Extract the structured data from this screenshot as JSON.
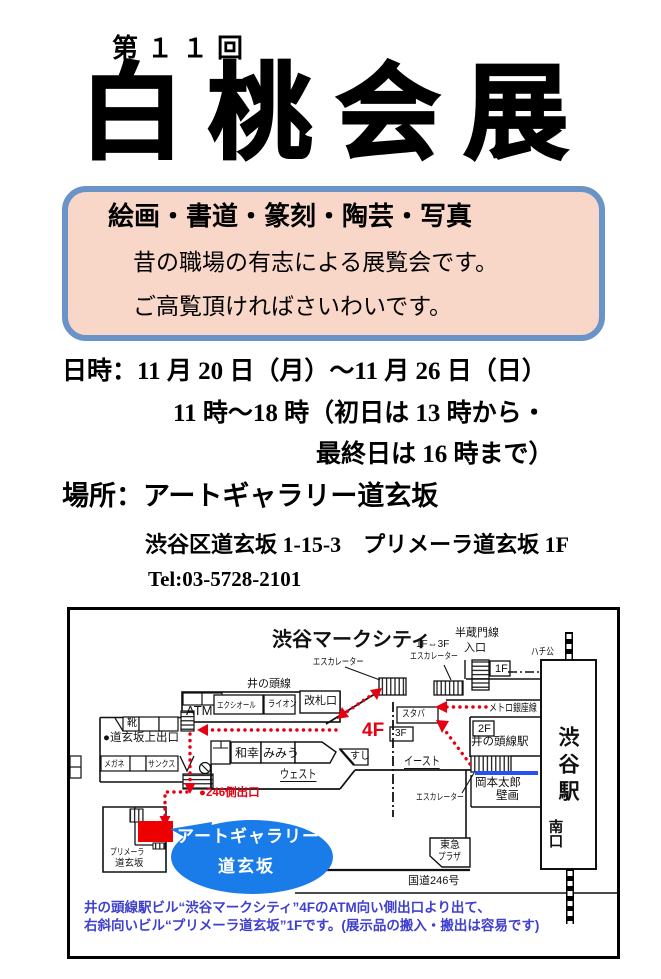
{
  "poster": {
    "edition": "第１１回",
    "title": "白桃会展",
    "intro": {
      "categories": "絵画・書道・篆刻・陶芸・写真",
      "line1": "昔の職場の有志による展覧会です。",
      "line2": "ご高覧頂ければさいわいです。"
    },
    "schedule": {
      "line1": "日時：11 月 20 日（月）～11 月 26 日（日）",
      "line2": "11 時～18 時（初日は 13 時から・",
      "line3": "最終日は 16 時まで）"
    },
    "venue": {
      "line1": "場所：アートギャラリー道玄坂",
      "line2": "渋谷区道玄坂 1-15-3　プリメーラ道玄坂 1F",
      "tel": "Tel:03-5728-2101"
    }
  },
  "map": {
    "labels": {
      "markcity": "渋谷マークシティ",
      "escalator1": "エスカレーター",
      "inokashira_line": "井の頭線",
      "kaisatsu": "改札口",
      "atm": "ATM",
      "excelsior": "エクシオール",
      "lion": "ライオン",
      "kutsu": "靴",
      "dogenzaka_exit": "●道玄坂上出口",
      "megane": "メガネ",
      "sunkus": "サンクス",
      "wako": "和幸",
      "mimiu": "みみう",
      "west": "ウェスト",
      "sushi": "すし",
      "east": "イースト",
      "staba": "スタバ",
      "f4": "4F",
      "f3": "3F",
      "f2": "2F",
      "f1": "1F",
      "f1f3": "1F⇔3F",
      "escalator2": "エスカレーター",
      "hanzomon": "半蔵門線",
      "iriguchi": "入口",
      "hachiko": "ハチ公",
      "metro_ginza": "メトロ銀座線",
      "inokashira_sta": "井の頭線駅",
      "shibuya_sta": "渋谷駅",
      "minamiguchi": "南口",
      "okamoto": "岡本太郎",
      "hekiga": "壁画",
      "tokyu": "東急",
      "plaza": "プラザ",
      "route246": "国道246号",
      "exit246": "●246側出口",
      "primera1": "プリメーラ",
      "primera2": "道玄坂",
      "escalator3": "エスカレーター",
      "bubble1": "アートギャラリー",
      "bubble2": "道玄坂"
    },
    "note1": "井の頭線駅ビル“渋谷マークシティ”4FのATM向い側出口より出て、",
    "note2": "右斜向いビル“プリメーラ道玄坂”1Fです。(展示品の搬入・搬出は容易です)",
    "colors": {
      "route_red": "#e60012",
      "marker_red": "#ee0000",
      "bubble_blue": "#1a7ce8",
      "line_blue": "#2950f0",
      "note_blue": "#4040cf",
      "box_border": "#6a93c8",
      "box_fill": "#f8d6c8"
    }
  }
}
